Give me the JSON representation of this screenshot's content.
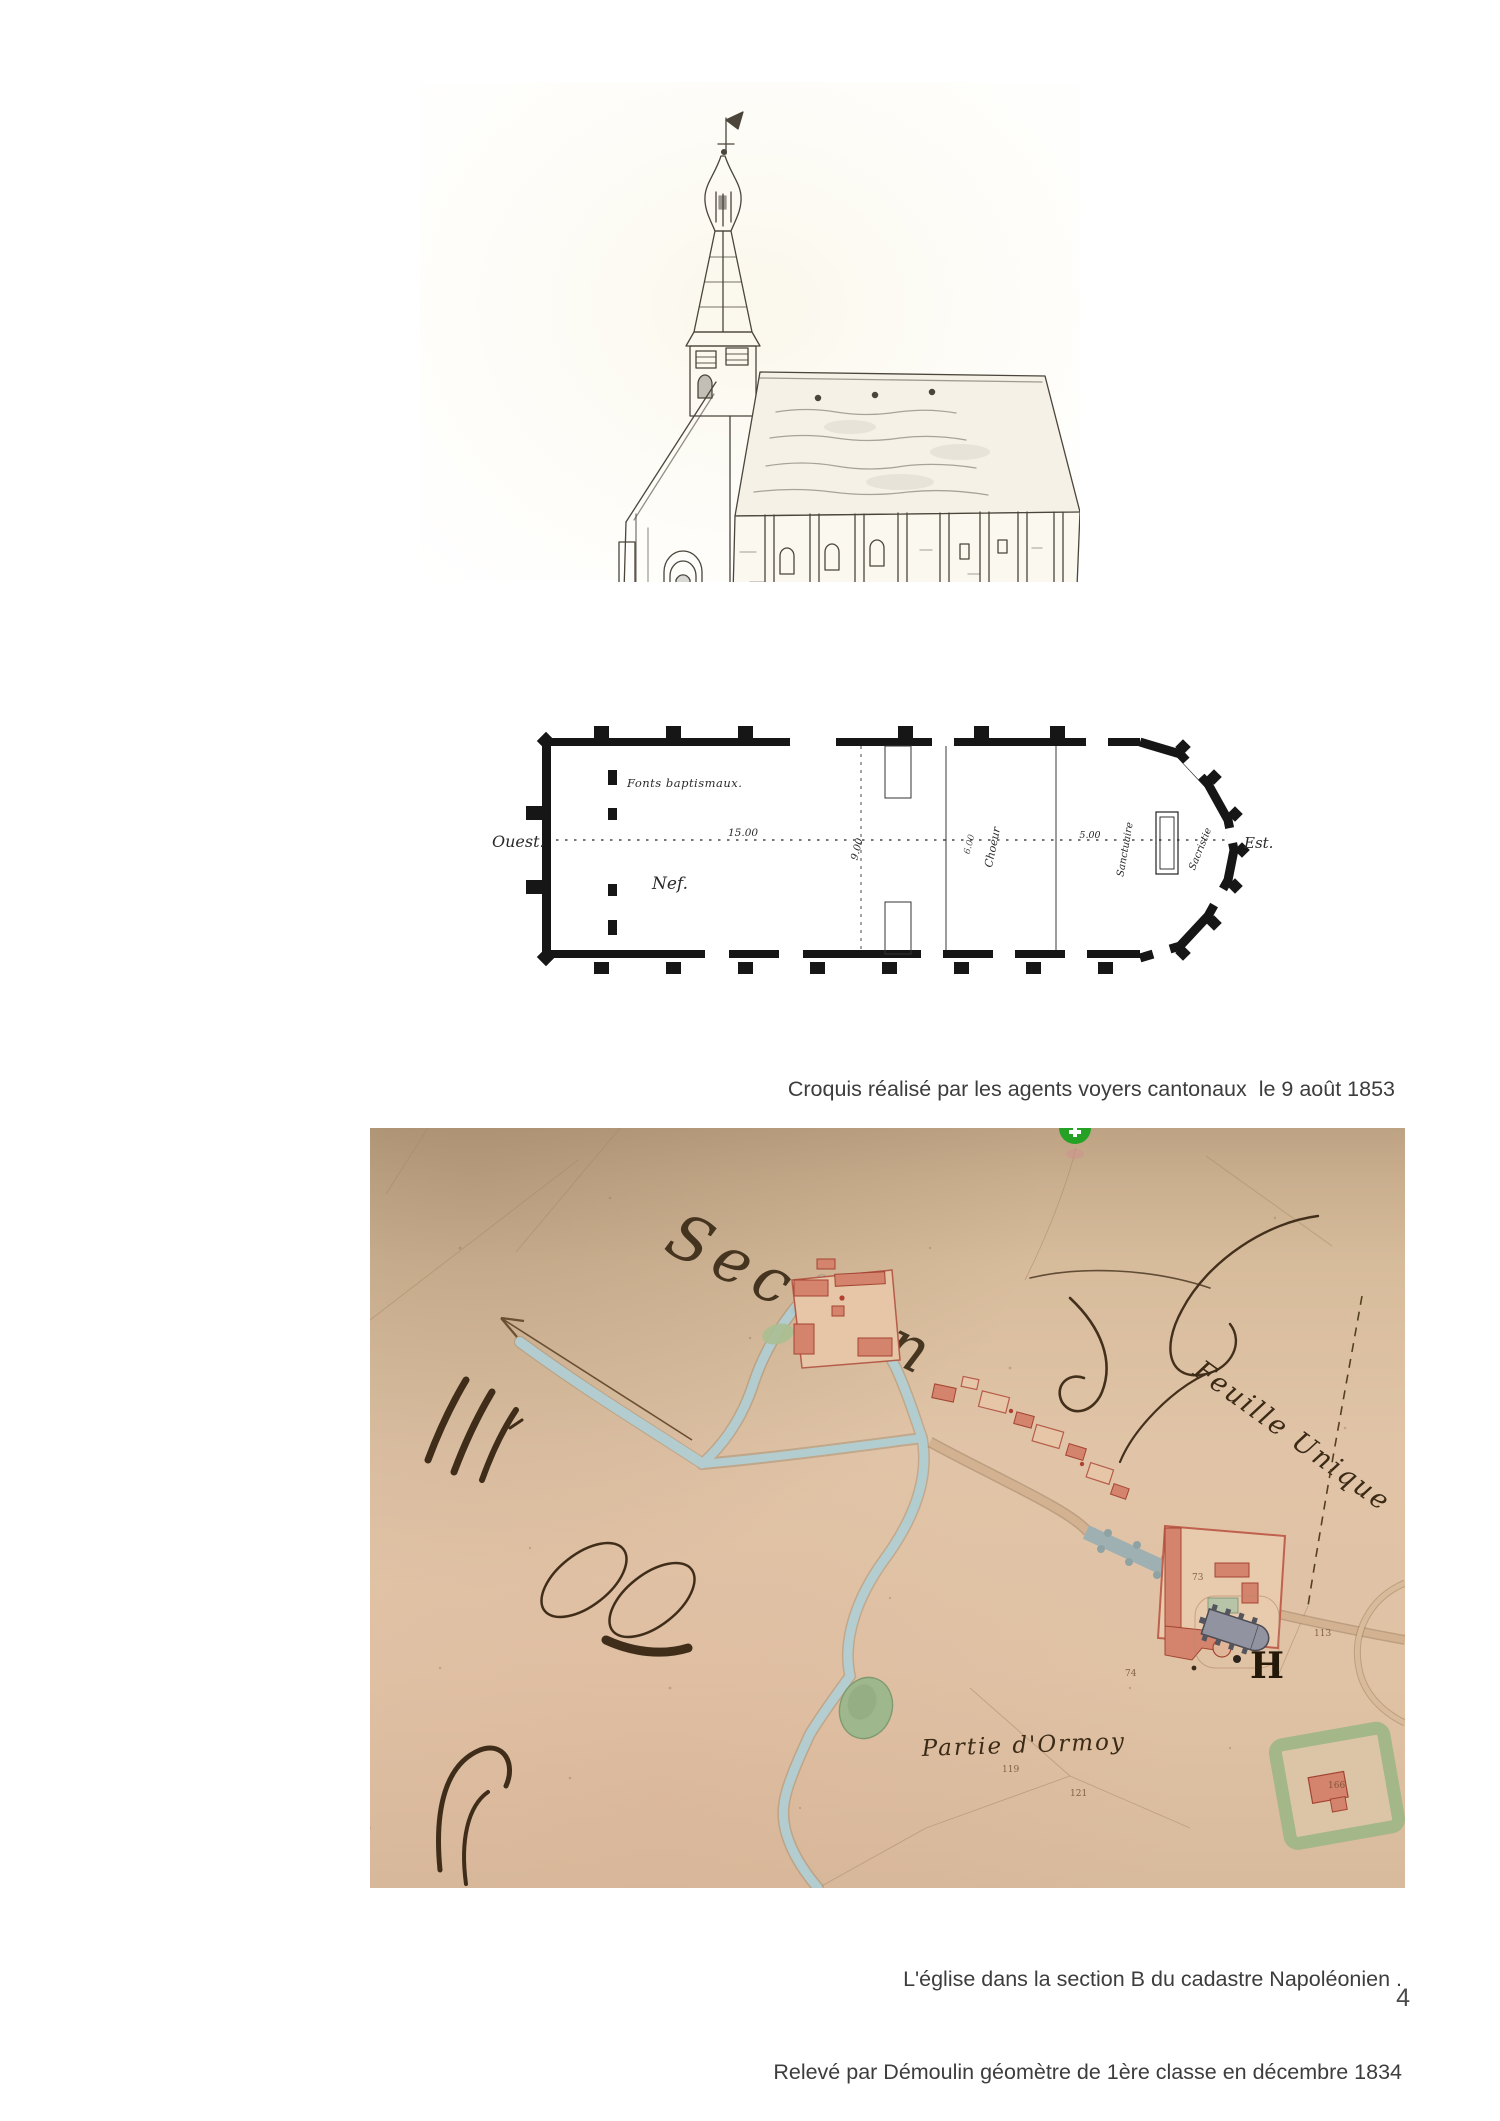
{
  "page": {
    "number": "4"
  },
  "church_sketch": {
    "caption_line1": "Croquis réalisé par les agents voyers cantonaux  le 9 août 1853",
    "caption_line2": "(Archives départementales)"
  },
  "floor_plan": {
    "orientation_west": "Ouest.",
    "orientation_east": "Est.",
    "label_fonts_baptismaux": "Fonts baptismaux.",
    "label_nef": "Nef.",
    "label_choeur": "Choeur",
    "label_sanctuaire": "Sanctuaire",
    "label_sacristie": "Sacristie",
    "dim_nef": "15.00",
    "dim_avant_choeur": "9.00",
    "dim_choeur": "6.00",
    "dim_sanctuaire": "5.00"
  },
  "cadastre_map": {
    "title_section": "Section",
    "sheet_label": "Feuille Unique",
    "place_label": "Partie d'Ormoy",
    "letter_h": "H",
    "parcel_numbers": [
      "74",
      "73",
      "119",
      "121",
      "113",
      "166"
    ],
    "caption_line1": "L'église dans la section B du cadastre Napoléonien .",
    "caption_line2": "Relevé par Démoulin géomètre de 1ère classe en décembre 1834",
    "colors": {
      "paper_tan": "#ddc1a3",
      "road_blue": "#b2cfd4",
      "building_pink": "#d4846d",
      "hedge_green": "#a3b788",
      "ink_brown": "#3b2a18",
      "pin_green": "#28a228"
    }
  }
}
